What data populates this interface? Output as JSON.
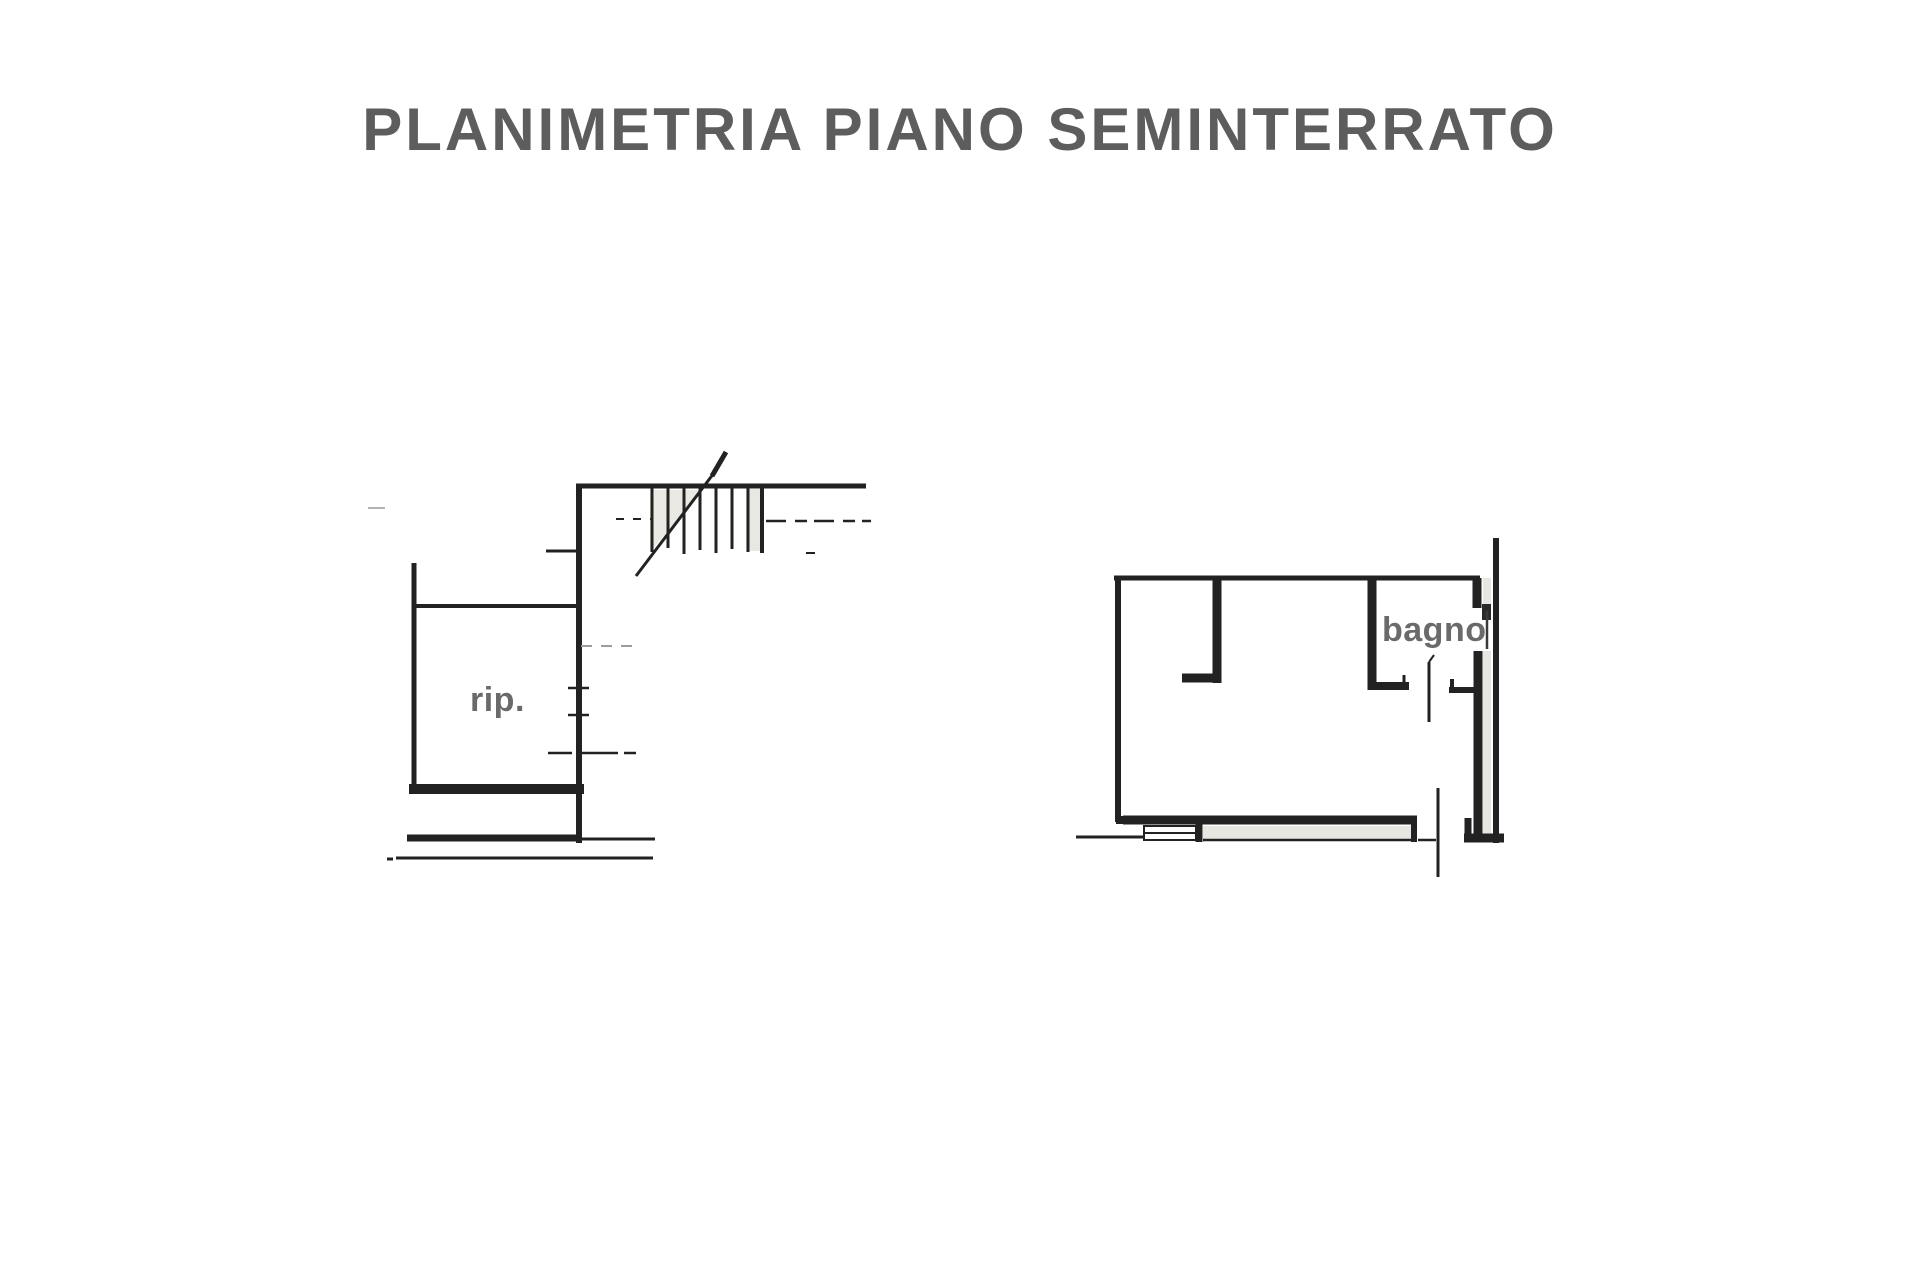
{
  "title": {
    "text": "PLANIMETRIA PIANO SEMINTERRATO"
  },
  "plans": {
    "left": {
      "label": "rip."
    },
    "right": {
      "label": "bagno"
    }
  },
  "style": {
    "background": "#ffffff",
    "ink_color": "#222222",
    "title_color": "#5d5d5d",
    "label_color": "#6a6a6a",
    "hatch_color": "#e7e7e2"
  }
}
